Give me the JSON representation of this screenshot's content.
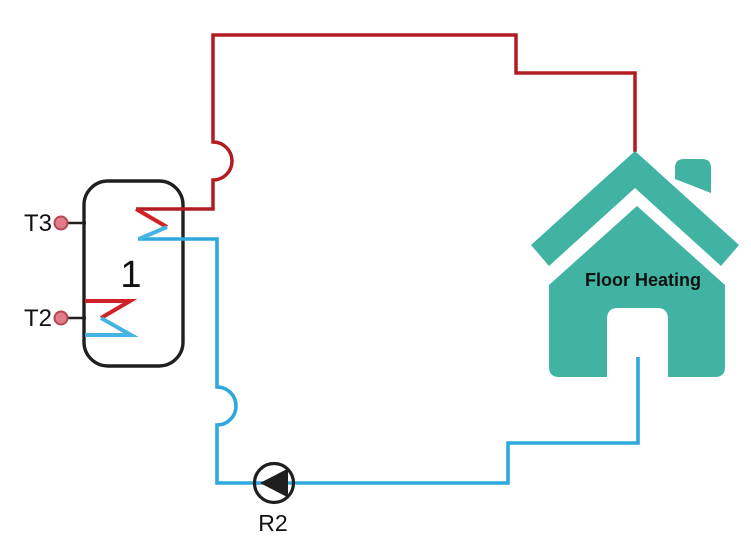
{
  "diagram": {
    "tank": {
      "number_label": "1",
      "top_sensor_label": "T3",
      "bottom_sensor_label": "T2"
    },
    "pump": {
      "label": "R2"
    },
    "house": {
      "label": "Floor Heating"
    },
    "colors": {
      "hot_pipe": "#b01c21",
      "hot_coil": "#cf2127",
      "cold_pipe": "#2fa8dd",
      "cold_coil": "#46b4e2",
      "house_teal": "#40b3a3",
      "sensor_fill": "#e07d8b",
      "sensor_stroke": "#b84553",
      "outline": "#1f1f1f",
      "text": "#111111"
    }
  }
}
